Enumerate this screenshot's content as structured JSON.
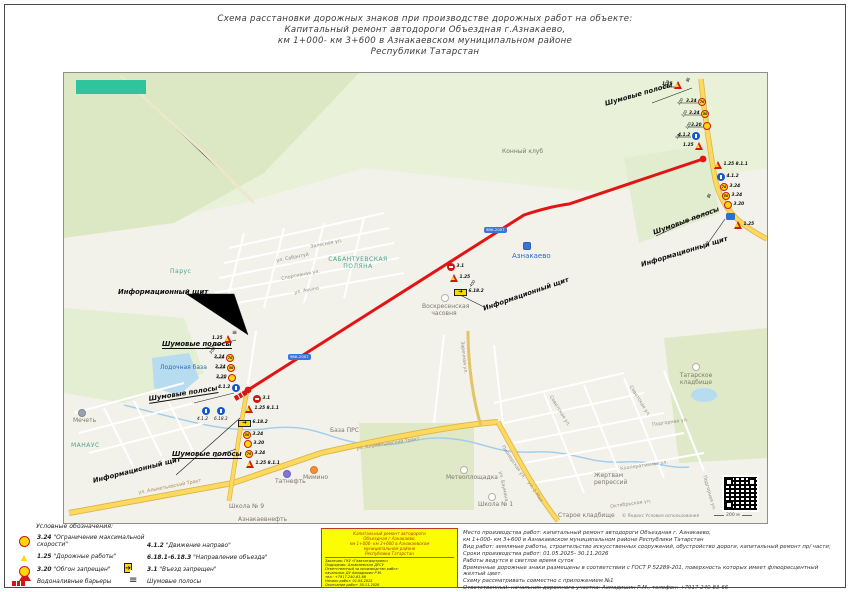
{
  "page": {
    "title": [
      "Схема расстановки дорожных знаков при производстве дорожных работ на объекте:",
      "Капитальный ремонт автодороги Объездная г.Азнакаево,",
      "км 1+000- км 3+600 в Азнакаевском муниципальном районе",
      "Республики Татарстан"
    ]
  },
  "colors": {
    "route_red": "#e31414",
    "sign_yellow": "#ffd800",
    "sign_blue": "#1557cf",
    "sign_red": "#d01616",
    "stamp_yellow": "#fdfd02"
  },
  "map": {
    "attribution": "© Яндекс  Условия использования",
    "scale": "200 м",
    "badge": "98К-2007",
    "callouts": {
      "info_board": "Информационный щит",
      "rumble": "Шумовые полосы"
    },
    "pois": {
      "konny": "Конный клуб",
      "aznakaevo": "Азнакаево",
      "chapel": "Воскресенская часовня",
      "polyana": "САБАНТУЕВСКАЯ ПОЛЯНА",
      "parus": "Парус",
      "boat_base": "Лодочная база",
      "mosque": "Мечеть",
      "manaus": "МАНАУС",
      "tatneft": "Татнефть",
      "mimino": "Мимино",
      "school9": "Школа № 9",
      "azneft": "Азнакаевнефть",
      "prs_base": "База ПРС",
      "meteo": "Метеоплощадка",
      "school1": "Школа № 1",
      "old_cem": "Старое кладбище",
      "tat_cem": "Татарское кладбище",
      "repress": "Жертвам репрессий"
    },
    "streets": {
      "zalesnaya": "Залесная ул.",
      "sabantuy": "ул. Сабантуй",
      "sport": "Спортивная ул.",
      "akyna": "ул. Акына",
      "trakt": "ул. Альметьевский Тракт",
      "sovet": "Советская ул.",
      "baumana": "ул. Баумана",
      "maya": "ул. 1 Мая",
      "pioner": "Пионерская ул.",
      "zarech": "Заречная ул.",
      "koop": "Кооперативная ул.",
      "podgor": "Подгорная ул.",
      "oktyabr": "Октябрьская ул."
    }
  },
  "codes": {
    "s324": "3.24",
    "s125": "1.25",
    "s320": "3.20",
    "s412": "4.1.2",
    "s31": "3.1",
    "s811": "8.1.1",
    "s6182": "6.18.2",
    "s6183": "6.18.3",
    "n70": "70",
    "n50": "50",
    "d400": "400",
    "d500": "500",
    "d300": "300",
    "d150": "150",
    "d100": "100",
    "d50": "50"
  },
  "legend": {
    "heading": "Условные обозначения:",
    "items": [
      {
        "code": "3.24",
        "label": "\"Ограничение максимальной скорости\""
      },
      {
        "code": "1.25",
        "label": "\"Дорожные работы\""
      },
      {
        "code": "3.20",
        "label": "\"Обгон запрещен\""
      },
      {
        "code": "",
        "label": "Водоналивные барьеры"
      },
      {
        "code": "4.1.2",
        "label": "\"Движение направо\""
      },
      {
        "code": "6.18.1-6.18.3",
        "label": "\"Направление объезда\""
      },
      {
        "code": "3.1",
        "label": "\"Въезд запрещен\""
      },
      {
        "code": "",
        "label": "Шумовые полосы"
      }
    ]
  },
  "stamp": {
    "header": [
      "Капитальный ремонт автодороги",
      "Объездная г.Азнакаево,",
      "км 1+000- км 3+600 в Азнакаевском",
      "муниципальном районе",
      "Республики Татарстан"
    ],
    "details": [
      "Заказчик: ГКУ «Главтатдортранс»",
      "Подрядчик: Азнакаевское ДРСУ",
      "Ответственный за производство работ:",
      "начальник ДУ Ахмадишин Р.М.",
      "тел.: +7917-240-83-66",
      "Начало работ: 01.05.2025",
      "Окончание работ: 30.11.2026"
    ]
  },
  "notes": {
    "lines": [
      "Место производства работ:  капитальный ремонт автодороги Объездная г. Азнакаево,",
      "км 1+000- км 3+600 в Азнакаевском муниципальном районе Республики Татарстан",
      "Вид работ:  земляные работы,  строительство искусственных сооружений,  обустройство дороги, капитальный ремонт пр/ части;",
      "Сроки производства работ:  01.05.2025- 30.11.2026",
      "Работы ведутся в светлое время суток",
      "Временные дорожные знаки размещены в соответствии с ГОСТ Р 52289-201, поверхность которых имеет флюоресцентный желтый цвет.",
      "Схему рассматривать совместно с приложением №1",
      "Ответственный:  начальник дорожного участка:  Ахмадишин Р.М.,  телефон:  +7917-240-83-66"
    ]
  }
}
